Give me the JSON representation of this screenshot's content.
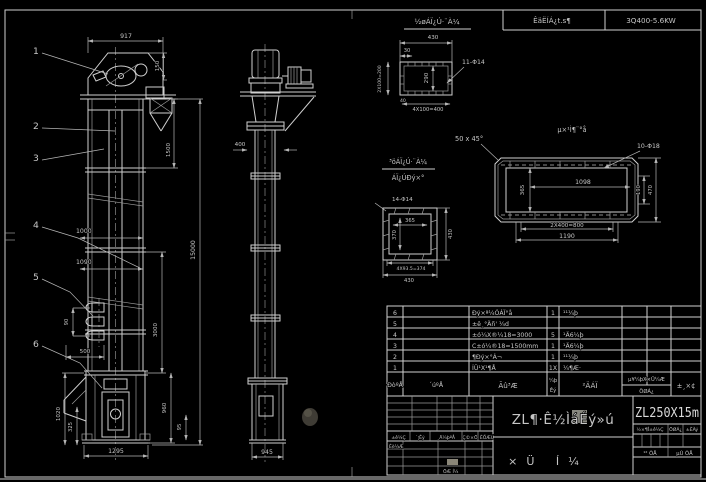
{
  "colors": {
    "background": "#000000",
    "line": "#cfcfcf",
    "dim_text": "#c6c6c6",
    "model_text": "#dadada"
  },
  "header_strip": {
    "throughput": "ÊäËÍÁ¿t.s¶",
    "power": "3Q400-5.6KW"
  },
  "front_view": {
    "balloon_1": "1",
    "balloon_2": "2",
    "balloon_3": "3",
    "balloon_4": "4",
    "balloon_5": "5",
    "balloon_6": "6",
    "dim_width_top": "917",
    "dim_head": "150",
    "dim_section": "1500",
    "dim_total": "15000",
    "dim_pitch_a": "1000",
    "dim_pitch_b": "1090",
    "dim_ladder_h": "90",
    "dim_ladder_w": "500",
    "dim_lower": "3000",
    "dim_boot_h": "960",
    "dim_boot_s": "95",
    "dim_boot_l1": "1020",
    "dim_boot_l2": "325",
    "dim_base": "1295"
  },
  "side_view": {
    "dim_ring": "400",
    "dim_base": "945"
  },
  "detail_inlet": {
    "title": "½øÁÏ¿Ú·¨À¼",
    "dim_width": "430",
    "dim_30": "30",
    "dim_40": "40",
    "holes": "11-Φ14",
    "dim_inner": "290",
    "dim_left": "2X100=200",
    "dim_bottom": "4X100=400"
  },
  "detail_plate": {
    "title": "µ×¹Ì¶¨°å",
    "chamfer": "50 x 45°",
    "holes": "10-Φ18",
    "dim_inner_w": "1098",
    "dim_inner_h": "365",
    "dim_h1": "190",
    "dim_h2": "470",
    "dim_b1": "2X400=800",
    "dim_b2": "1190"
  },
  "detail_outlet": {
    "title_1": "³öÁÏ¿Ú·¨À¼",
    "title_2": "ÁÏ¿ÚÐý×°",
    "holes": "14-Φ14",
    "dim_inner_w": "365",
    "dim_inner_h": "370",
    "dim_right": "430",
    "dim_b1": "4X93.5=374",
    "dim_b2": "430"
  },
  "bom": {
    "headers": {
      "no": "ÐòºÅ",
      "code": "´úºÅ",
      "name": "Ãû³Æ",
      "qty_1": "¼þ",
      "qty_2": "Êý",
      "material": "²ÄÁÏ",
      "weight_top": "µ¥¼þX×Ü¼Æ",
      "weight_bottom": "ÖØÁ¿",
      "note": "±¸×¢"
    },
    "rows": [
      {
        "no": "6",
        "name": "Ðý×ª¼ÓÁÏ°å",
        "qty": "1",
        "material": "¹¹¼þ"
      },
      {
        "no": "5",
        "name": "±ê¸°Äñ' ¼d",
        "qty": "",
        "material": ""
      },
      {
        "no": "4",
        "name": "±ó¼X®¼18=3000",
        "qty": "5",
        "material": "¹Ä6¼þ"
      },
      {
        "no": "3",
        "name": "C±ó¼®18=1500mm",
        "qty": "1",
        "material": "¹Ä6¼þ"
      },
      {
        "no": "2",
        "name": "¶Ðý×°Á¬",
        "qty": "1",
        "material": "¹¹¼þ"
      },
      {
        "no": "1",
        "name": "ÍÜ¹X¹¶Å",
        "qty": "1X",
        "material": "¼¶Æ·"
      }
    ]
  },
  "title_block": {
    "rev_headers": [
      "±ê¼Ç",
      "´¦Êý",
      "¸Ä¼þºÅ",
      "Ç©×Ö",
      "ÈÕÆÚ"
    ],
    "design": "Éè¼Æ",
    "draw": "ÖÆ Í¼",
    "product": "ZL¶·Ê½ÌáÉý»ú",
    "drawing_type": "×Ü Í¼",
    "model": "ZL250X15m",
    "stage": "½×¶Î±ê¼Ç",
    "weight": "ÖØÁ¿",
    "scale": "±ÈÀý",
    "sheets": "¹² ÕÅ",
    "sheet_no": "µÚ ÕÅ"
  }
}
